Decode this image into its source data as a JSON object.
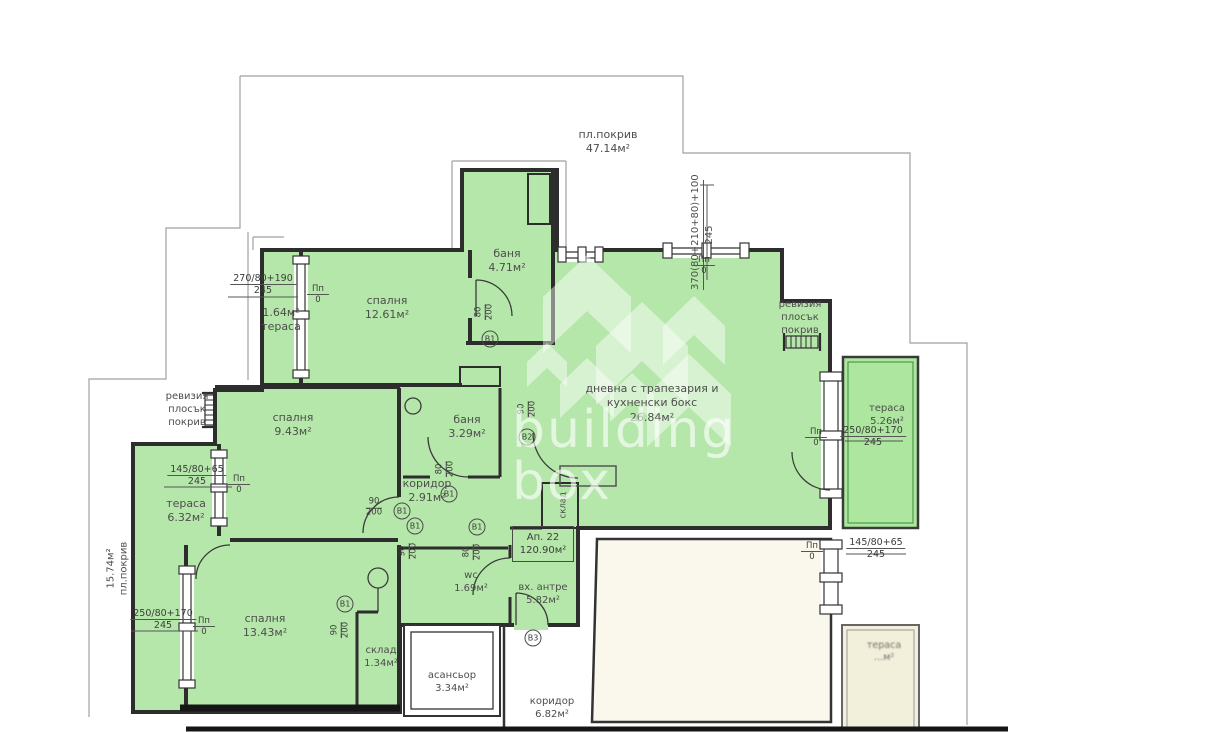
{
  "title": "floor-plan-apartment-22",
  "watermark": {
    "l1": "building",
    "l2": "box"
  },
  "apartment_box": {
    "l1": "Ап. 22",
    "l2": "120.90м²"
  },
  "rooms": {
    "roof_top": {
      "l1": "пл.покрив",
      "l2": "47.14м²"
    },
    "terasa164": {
      "l1": "1.64м²",
      "l2": "тераса"
    },
    "spalnya1261": {
      "l1": "спалня",
      "l2": "12.61м²"
    },
    "banya471": {
      "l1": "баня",
      "l2": "4.71м²"
    },
    "dnevna": {
      "l1": "дневна с трапезария и",
      "l2": "кухненски бокс",
      "l3": "26.84м²"
    },
    "revizia": {
      "l1": "ревизия",
      "l2": "плосък",
      "l3": "покрив"
    },
    "terasa526": {
      "l1": "тераса",
      "l2": "5.26м²"
    },
    "spalnya943": {
      "l1": "спалня",
      "l2": "9.43м²"
    },
    "terasa632": {
      "l1": "тераса",
      "l2": "6.32м²"
    },
    "roof_left": {
      "l1": "15.74м²",
      "l2": "пл.покрив"
    },
    "banya329": {
      "l1": "баня",
      "l2": "3.29м²"
    },
    "koridor291": {
      "l1": "коридор",
      "l2": "2.91м²"
    },
    "sklad_closet": {
      "l1": "склад"
    },
    "spalnya1343": {
      "l1": "спалня",
      "l2": "13.43м²"
    },
    "sklad134": {
      "l1": "склад",
      "l2": "1.34м²"
    },
    "wc": {
      "l1": "wc",
      "l2": "1.69м²"
    },
    "antre": {
      "l1": "вх. антре",
      "l2": "5.82м²"
    },
    "asansior": {
      "l1": "асансьор",
      "l2": "3.34м²"
    },
    "koridor682": {
      "l1": "коридор",
      "l2": "6.82м²"
    },
    "terasa_br": {
      "l1": "тераса",
      "l2": "…м²"
    }
  },
  "dims": {
    "d370": {
      "t": "370(80+210+80)+100",
      "b": "245"
    },
    "d270": {
      "t": "270/80+190",
      "b": "245"
    },
    "d250": {
      "t": "250/80+170",
      "b": "245"
    },
    "d145": {
      "t": "145/80+65",
      "b": "245"
    },
    "pp": {
      "t": "Пп",
      "b": "0"
    }
  },
  "doors": {
    "b1": "B1",
    "b2": "B2",
    "b3": "B3",
    "s80": "80",
    "s90": "90",
    "s200": "200"
  },
  "colors": {
    "green": "#b6e7aa",
    "terrace_green": "#ace69f",
    "beige": "#f2efda",
    "cream": "#faf7ec",
    "wall": "#2d2d2d",
    "roofline": "#a0a0a0",
    "text": "#4d4d4d"
  }
}
